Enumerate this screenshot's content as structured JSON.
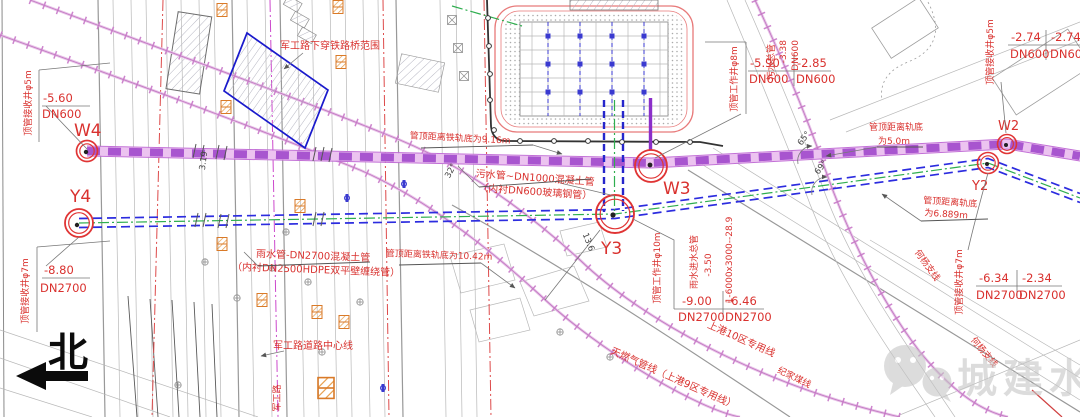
{
  "drawing": {
    "north_label": "北",
    "watermark": "城建水业"
  },
  "nodes": {
    "w4": "W4",
    "y4": "Y4",
    "w3": "W3",
    "y3": "Y3",
    "w2": "W2",
    "y2": "Y2"
  },
  "callouts": {
    "w4": {
      "shaft": "顶管接收井φ5m",
      "elev": "-5.60",
      "dn": "DN600"
    },
    "y4": {
      "shaft": "顶管接收井φ7m",
      "elev": "-8.80",
      "dn": "DN2700"
    },
    "w3": {
      "shaft": "顶管工作井φ8m",
      "vt1": "污水总管",
      "vt2": "-3.38",
      "vt3": "DN600",
      "elev1": "-5.90",
      "dn1": "DN600",
      "elev2": "-2.85",
      "dn2": "DN600"
    },
    "w2": {
      "shaft": "顶管接收井φ5m",
      "elev1": "-2.74",
      "dn1": "DN600",
      "elev2": "-2.74",
      "dn2": "DN600"
    },
    "y3": {
      "shaft": "顶管工作井φ10m",
      "vt1": "雨水进水总管",
      "vt2": "-3.50",
      "vt3": "1-6000x3000--28.9",
      "elev1": "-9.00",
      "dn1": "DN2700",
      "elev2": "-6.46",
      "dn2": "DN2700"
    },
    "y2": {
      "shaft": "顶管接收井φ7m",
      "elev1": "-6.34",
      "dn1": "DN2700",
      "elev2": "-2.34",
      "dn2": "DN2700"
    }
  },
  "pipes": {
    "sewage1": "污水管~DN1000混凝土管",
    "sewage2": "（内衬DN600玻璃钢管）",
    "rain1": "雨水管-DN2700混凝土管",
    "rain2": "（内衬DN2500HDPE双平壁缠绕管）"
  },
  "distances": {
    "d1": "管顶距离铁轨底为9.16m",
    "d2": "管顶距离铁轨底为10.42m",
    "d3a": "管顶距离轨底",
    "d3b": "为5.0m",
    "d4a": "管顶距离轨底",
    "d4b": "为6.889m"
  },
  "areas": {
    "bridge_zone": "军工路下穿铁路桥范围",
    "road_center": "军工路道路中心线",
    "road": "军工路",
    "rail_a": "上港10区专用线",
    "rail_b": "天燃气管线（上港9区专用线）",
    "rail_c": "纪家煤线",
    "rail_d": "何杨支线",
    "rail_e": "何杨支线"
  },
  "dims": {
    "a1": "65°",
    "a2": "69°",
    "a3": "32°",
    "l1": "13.6",
    "l2": "3.19"
  }
}
